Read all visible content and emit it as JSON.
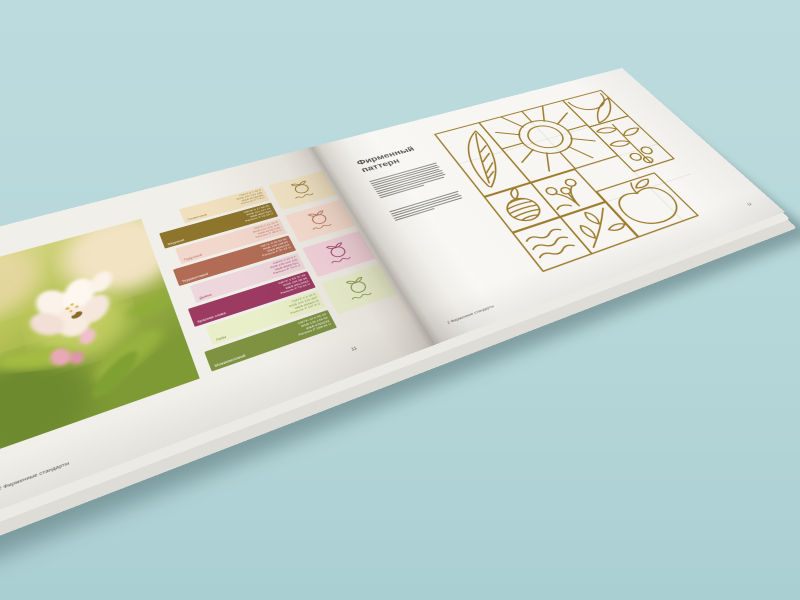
{
  "background": "#B6D7D9",
  "book": {
    "left_page": {
      "page_number": "11",
      "footer": "2 Фирменные стандарты",
      "photo": {
        "subject": "apple-blossom-with-bee"
      },
      "swatches": [
        {
          "name": "Сливочный",
          "bg": "#F0E0BD",
          "fg": "#8D752C",
          "cmyk": "CMYK 0 7 24 0",
          "rgb": "RGB 240 224 189",
          "web": "WEB #F0E0BD",
          "pantone": "Pantone P 7-9 U"
        },
        {
          "name": "Медовый",
          "bg": "#8D752C",
          "fg": "#FFFFFF",
          "cmyk": "CMYK 0 17 69 45",
          "rgb": "RGB 141 117 44",
          "web": "WEB #8D752C",
          "pantone": "Pantone P 12-16 U"
        },
        {
          "name": "Пудровый",
          "bg": "#F2D7CD",
          "fg": "#B26C55",
          "cmyk": "CMYK 0 11 15 5",
          "rgb": "RGB 242 215 205",
          "web": "WEB #F2D7CD",
          "pantone": "Pantone P 58-9 U"
        },
        {
          "name": "Терракотовый",
          "bg": "#B26C55",
          "fg": "#FFFFFF",
          "cmyk": "CMYK 0 39 52 30",
          "rgb": "RGB 178 108 85",
          "web": "WEB #B26C55",
          "pantone": "Pantone P 37-12 U"
        },
        {
          "name": "Дымка",
          "bg": "#EED7DC",
          "fg": "#9C3A62",
          "cmyk": "CMYK 0 10 3 7",
          "rgb": "RGB 238 215 220",
          "web": "WEB #EED7DC",
          "pantone": "Pantone P 73-9 U"
        },
        {
          "name": "Красная слива",
          "bg": "#9C3A62",
          "fg": "#FFFFFF",
          "cmyk": "CMYK 0 63 37 39",
          "rgb": "RGB 156 58 98",
          "web": "WEB #9C3A62",
          "pantone": "Pantone P 70-16 U"
        },
        {
          "name": "Лайм",
          "bg": "#E9EFC8",
          "fg": "#7E9242",
          "cmyk": "CMYK 3 0 16 6",
          "rgb": "RGB 233 239 200",
          "web": "WEB #E9EFC8",
          "pantone": "Pantone P 157-9 U"
        },
        {
          "name": "Можжевеловый",
          "bg": "#7E9242",
          "fg": "#FFFFFF",
          "cmyk": "CMYK 14 0 55 43",
          "rgb": "RGB 126 146 66",
          "web": "WEB #7E9242",
          "pantone": "Pantone P 158-16 U"
        }
      ],
      "logo_tiles": [
        {
          "bg": "#F5E8C8",
          "fg": "#8D752C"
        },
        {
          "bg": "#F9DFD2",
          "fg": "#B26C55"
        },
        {
          "bg": "#F4D4DF",
          "fg": "#9C3A62"
        },
        {
          "bg": "#EAF0CF",
          "fg": "#7E9242"
        }
      ]
    },
    "right_page": {
      "title_line1": "Фирменный",
      "title_line2": "паттерн",
      "page_number": "12",
      "footer": "2 Фирменные стандарты",
      "pattern": {
        "stroke": "#9D7B2D",
        "grid": "#CFCDC7",
        "tiles": [
          "leaf",
          "sun",
          "crescents",
          "rowan-branch",
          "berry-sprig",
          "leafy-twig",
          "honey-ball",
          "waves",
          "apple"
        ]
      }
    }
  }
}
